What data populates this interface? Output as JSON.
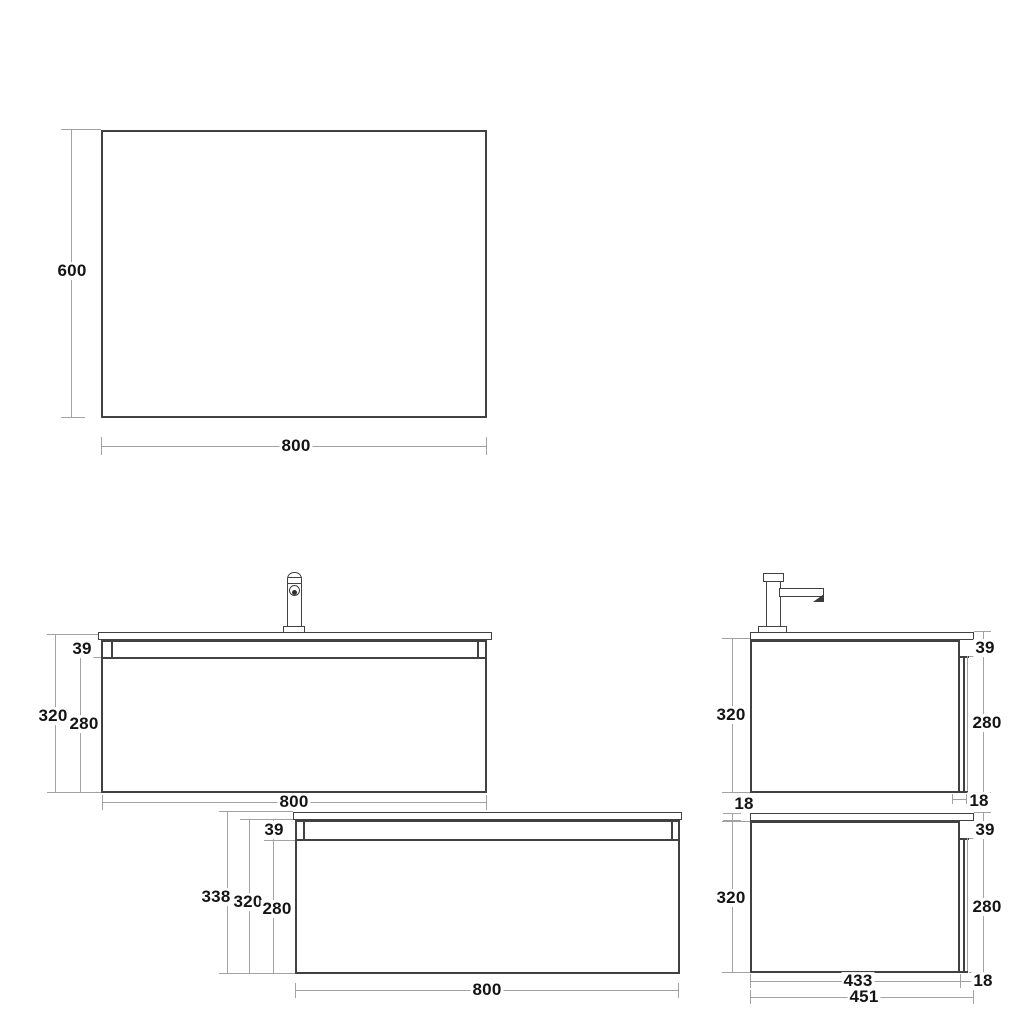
{
  "background": "#ffffff",
  "colors": {
    "object_line": "#414141",
    "dimension_line": "#a2a2a2",
    "label_text": "#141414"
  },
  "views": {
    "mirror": {
      "height": "600",
      "width": "800"
    },
    "front_with_faucet": {
      "apron_height": "39",
      "total_height": "320",
      "carcass_height": "280",
      "width": "800"
    },
    "side_with_faucet": {
      "total_height": "320",
      "apron_height": "39",
      "carcass_height": "280",
      "top_panel_thickness": "18",
      "back_lip_thickness": "18"
    },
    "front_plain": {
      "apron_height": "39",
      "overall_height": "338",
      "total_height": "320",
      "carcass_height": "280",
      "width": "800"
    },
    "side_plain": {
      "total_height": "320",
      "apron_height": "39",
      "carcass_height": "280",
      "carcass_depth": "433",
      "overall_depth": "451",
      "top_overhang": "18"
    }
  }
}
